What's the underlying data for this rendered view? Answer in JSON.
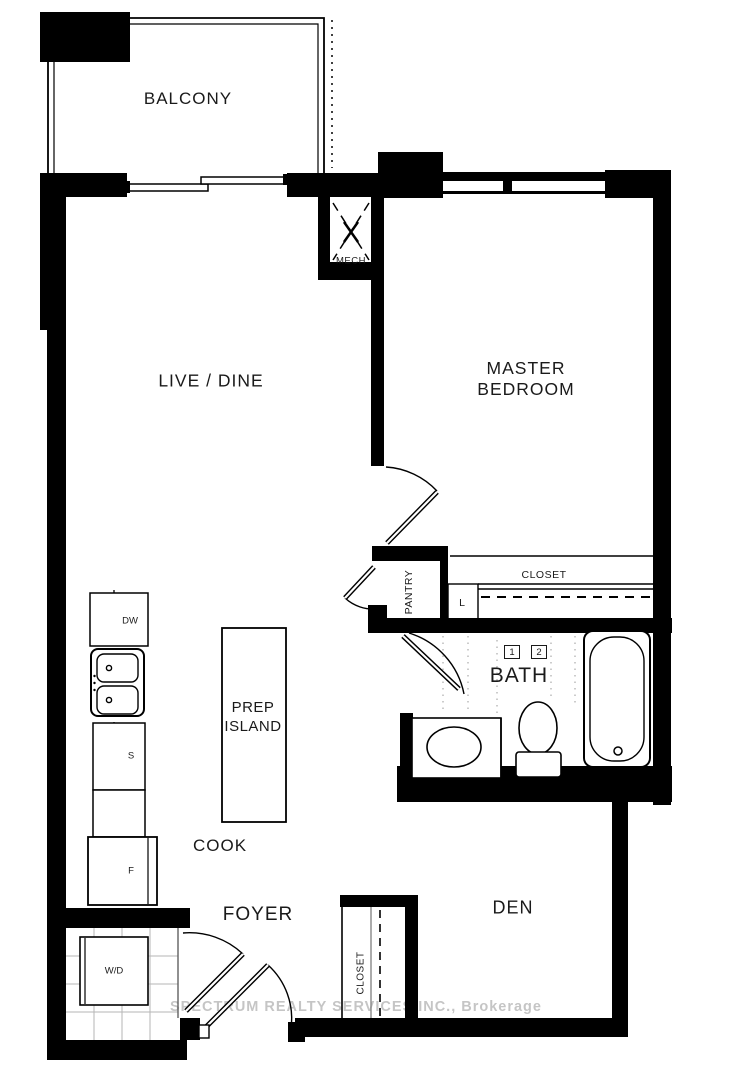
{
  "rooms": {
    "balcony": "BALCONY",
    "live_dine": "LIVE / DINE",
    "master_bedroom": "MASTER BEDROOM",
    "mech": "MECH",
    "pantry": "PANTRY",
    "linen": "L",
    "master_closet": "CLOSET",
    "bath": "BATH",
    "prep_island": "PREP ISLAND",
    "cook": "COOK",
    "foyer": "FOYER",
    "foyer_closet": "CLOSET",
    "den": "DEN"
  },
  "fixtures": {
    "dishwasher": "DW",
    "stove": "S",
    "fridge": "F",
    "washer_dryer": "W/D"
  },
  "markers": {
    "tile_1": "1",
    "tile_2": "2"
  },
  "watermark": "SPECTRUM REALTY SERVICES INC., Brokerage",
  "colors": {
    "wall": "#000000",
    "background": "#ffffff",
    "watermark_gray": "#969696"
  }
}
